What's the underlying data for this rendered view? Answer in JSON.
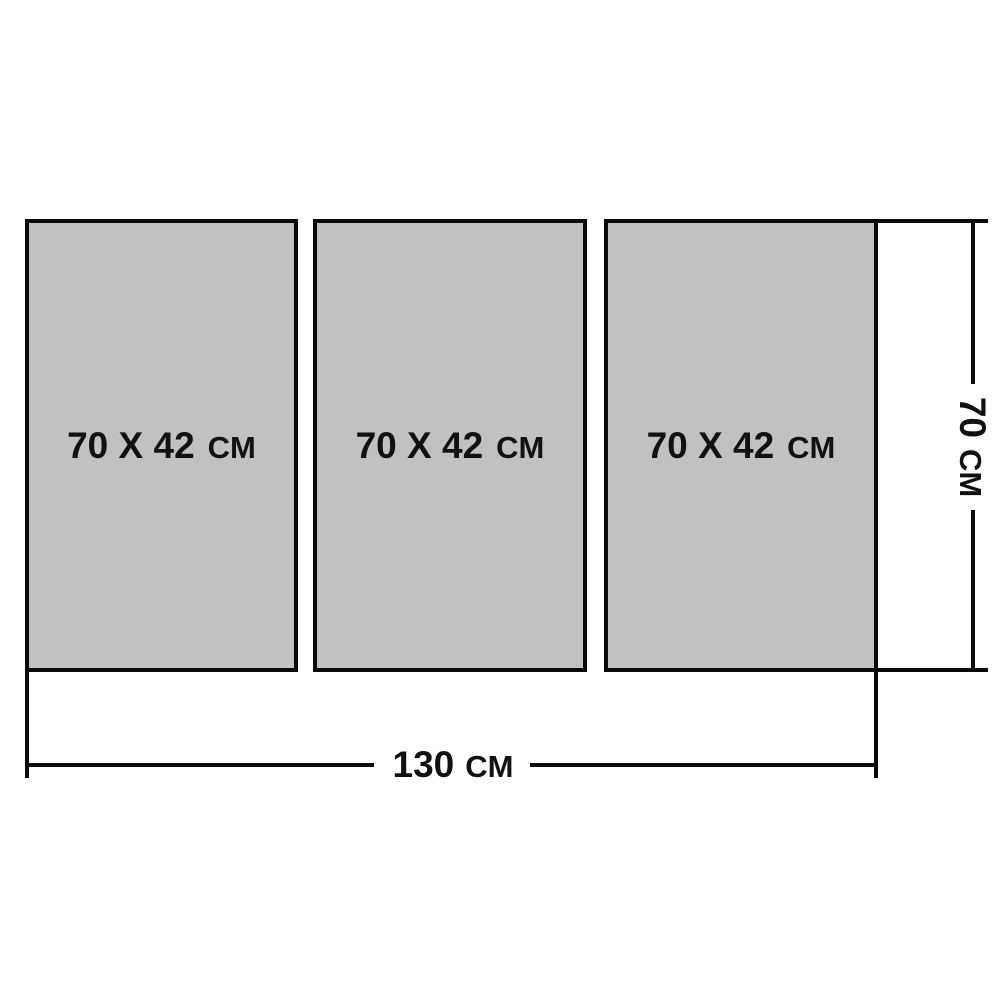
{
  "panels": [
    {
      "size": "70 X 42",
      "unit": "CM"
    },
    {
      "size": "70 X 42",
      "unit": "CM"
    },
    {
      "size": "70 X 42",
      "unit": "CM"
    }
  ],
  "dimensions": {
    "width": {
      "value": "130",
      "unit": "CM"
    },
    "height": {
      "value": "70",
      "unit": "CM"
    }
  },
  "colors": {
    "panel_fill": "#c1c1c1",
    "line": "#0a0a0a",
    "text": "#111111",
    "background": "#ffffff"
  }
}
